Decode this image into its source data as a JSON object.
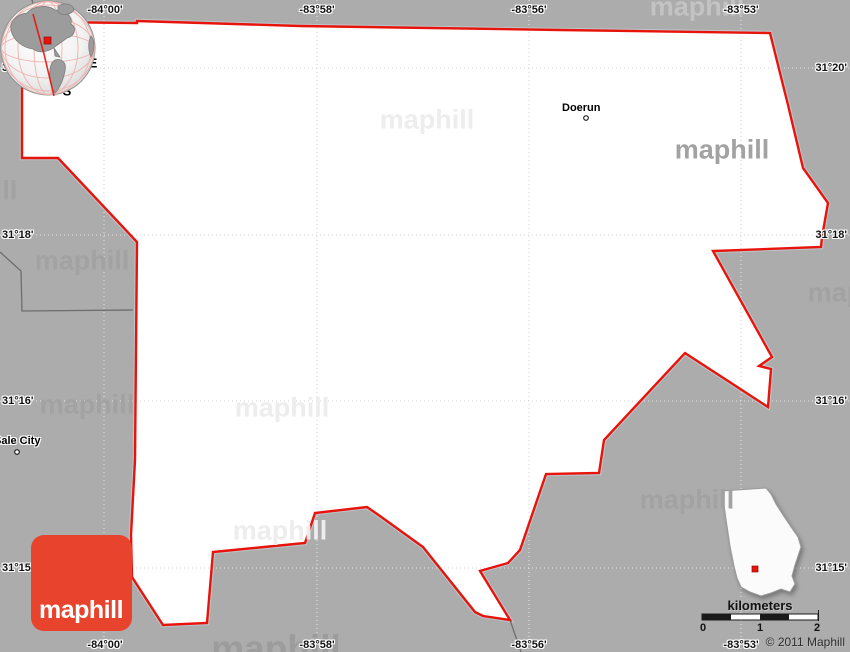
{
  "canvas": {
    "width": 850,
    "height": 652
  },
  "coordinates": {
    "top": [
      "-84°00'",
      "-83°58'",
      "-83°56'",
      "-83°53'"
    ],
    "bottom": [
      "-84°00'",
      "-83°58'",
      "-83°56'",
      "-83°53'"
    ],
    "left": [
      "31°20'",
      "31°18'",
      "31°16'",
      "31°15'"
    ],
    "right": [
      "31°20'",
      "31°18'",
      "31°16'",
      "31°15'"
    ]
  },
  "compass": {
    "north": "N",
    "east": "E",
    "south": "S",
    "west": "W"
  },
  "places": {
    "doerun": "Doerun",
    "sale_city": "Sale City"
  },
  "watermark_text": "maphill",
  "logo_text": "maphill",
  "scale_bar": {
    "unit_label": "kilometers",
    "tick_labels": [
      "0",
      "1",
      "2"
    ]
  },
  "copyright_text": "© 2011 Maphill",
  "colors": {
    "background": "#acacac",
    "county_fill": "#ffffff",
    "county_border": "#e8130a",
    "border_casing": "#bcc6cb",
    "neighbor_boundary": "#6e6e6e",
    "graticule_on_white": "#d2d2d2",
    "graticule_on_gray": "#e8e8e8",
    "logo_background": "#e8432c",
    "logo_text_color": "#ffffff",
    "globe_land": "#9c9c9c",
    "inset_marker": "#e8130a",
    "scale_bar_dark": "#1a1a1a"
  }
}
